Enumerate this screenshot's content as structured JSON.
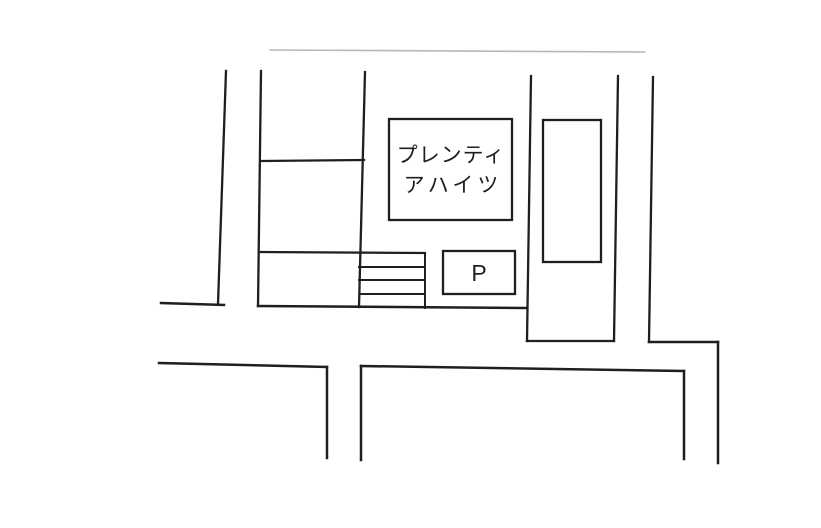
{
  "map": {
    "building": {
      "label_line1": "プレンティ",
      "label_line2": "アハイツ"
    },
    "parking": {
      "label": "P"
    },
    "colors": {
      "line": "#1f1f1f",
      "faint_line": "#b8b8b8",
      "background": "#ffffff"
    }
  }
}
